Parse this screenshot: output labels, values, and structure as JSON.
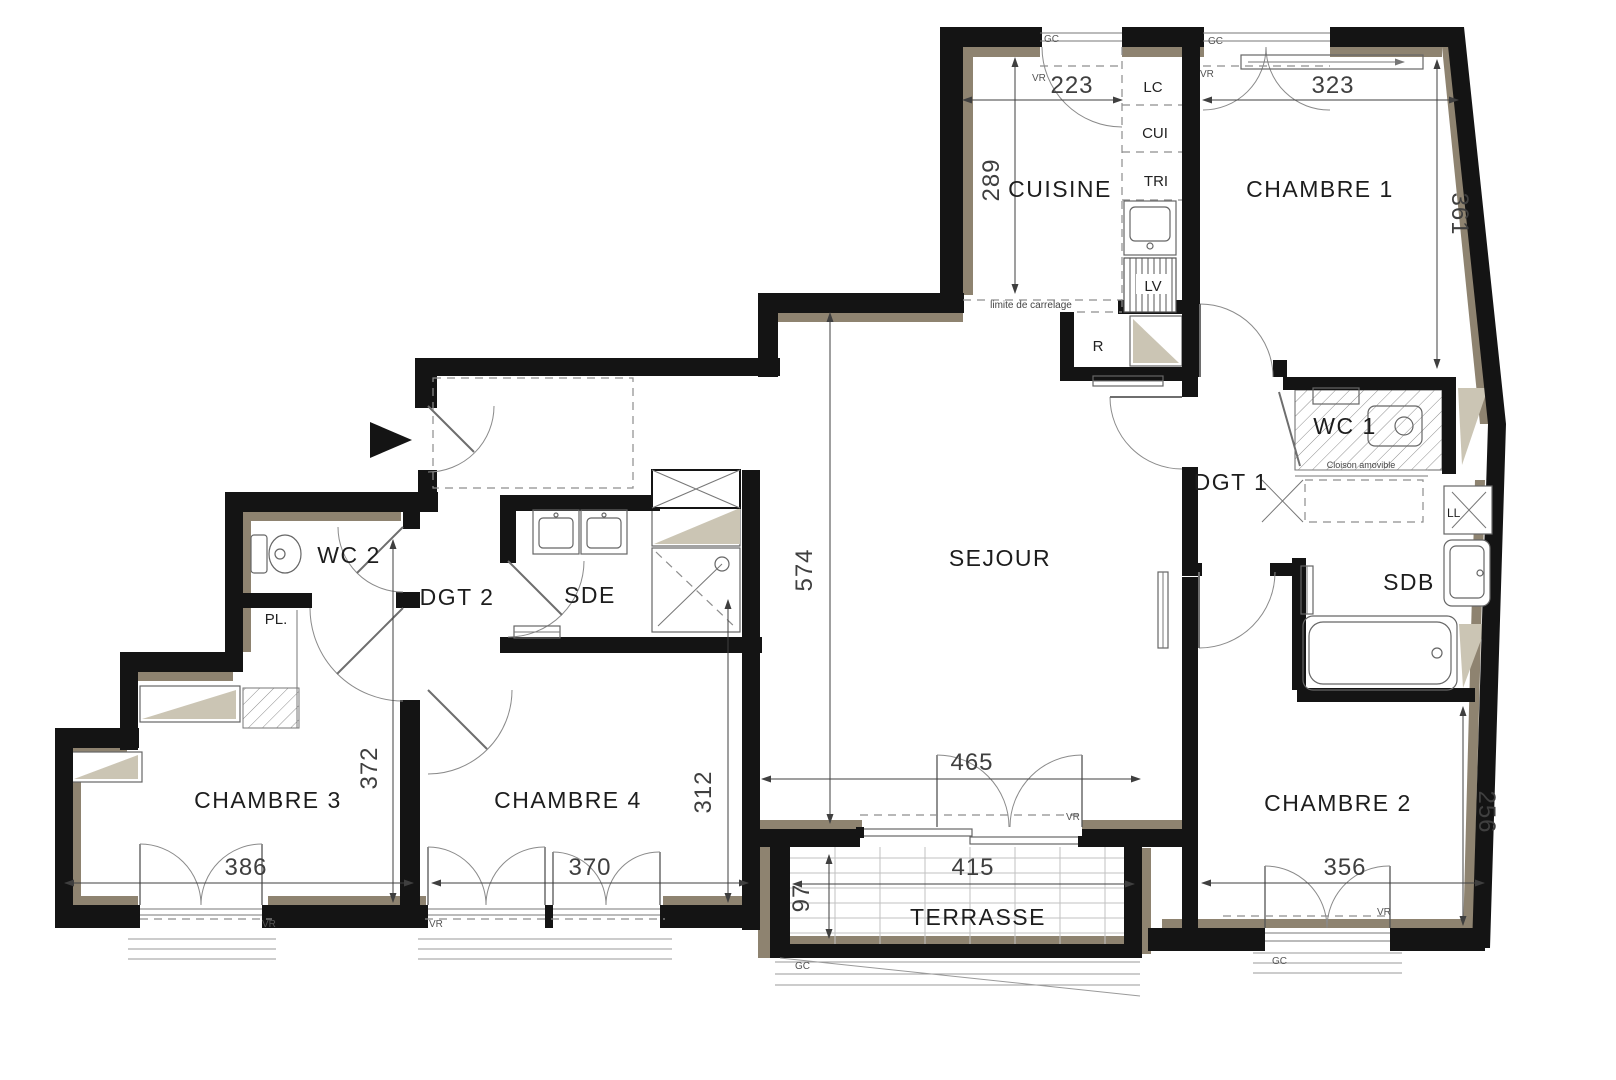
{
  "colors": {
    "wall": "#141414",
    "lining": "#8e8370",
    "lining_light": "#cbc5b4",
    "line": "#777777",
    "dimension": "#3f3f3f",
    "background": "#ffffff"
  },
  "rooms": {
    "cuisine": "CUISINE",
    "chambre1": "CHAMBRE 1",
    "wc1": "WC 1",
    "dgt1": "DGT 1",
    "sdb": "SDB",
    "sejour": "SEJOUR",
    "chambre2": "CHAMBRE 2",
    "terrasse": "TERRASSE",
    "chambre4": "CHAMBRE 4",
    "chambre3": "CHAMBRE 3",
    "sde": "SDE",
    "dgt2": "DGT 2",
    "wc2": "WC 2",
    "pl": "PL.",
    "r": "R"
  },
  "kitchen_units": {
    "lc": "LC",
    "cui": "CUI",
    "tri": "TRI",
    "lv": "LV"
  },
  "appliances": {
    "ll": "LL"
  },
  "tags": {
    "gc": "GC",
    "vr": "VR"
  },
  "annotations": {
    "tile_limit": "limite de carrelage",
    "movable_partition": "Cloison amovible"
  },
  "dimensions": {
    "cuisine_width": "223",
    "cuisine_height": "289",
    "chambre1_width": "323",
    "chambre1_height": "361",
    "sejour_height": "574",
    "sejour_width": "465",
    "terrasse_width": "415",
    "terrasse_depth": "97",
    "chambre2_width": "356",
    "chambre2_height": "256",
    "chambre3_width": "386",
    "chambre3_height": "372",
    "chambre4_width": "370",
    "chambre4_height": "312"
  }
}
